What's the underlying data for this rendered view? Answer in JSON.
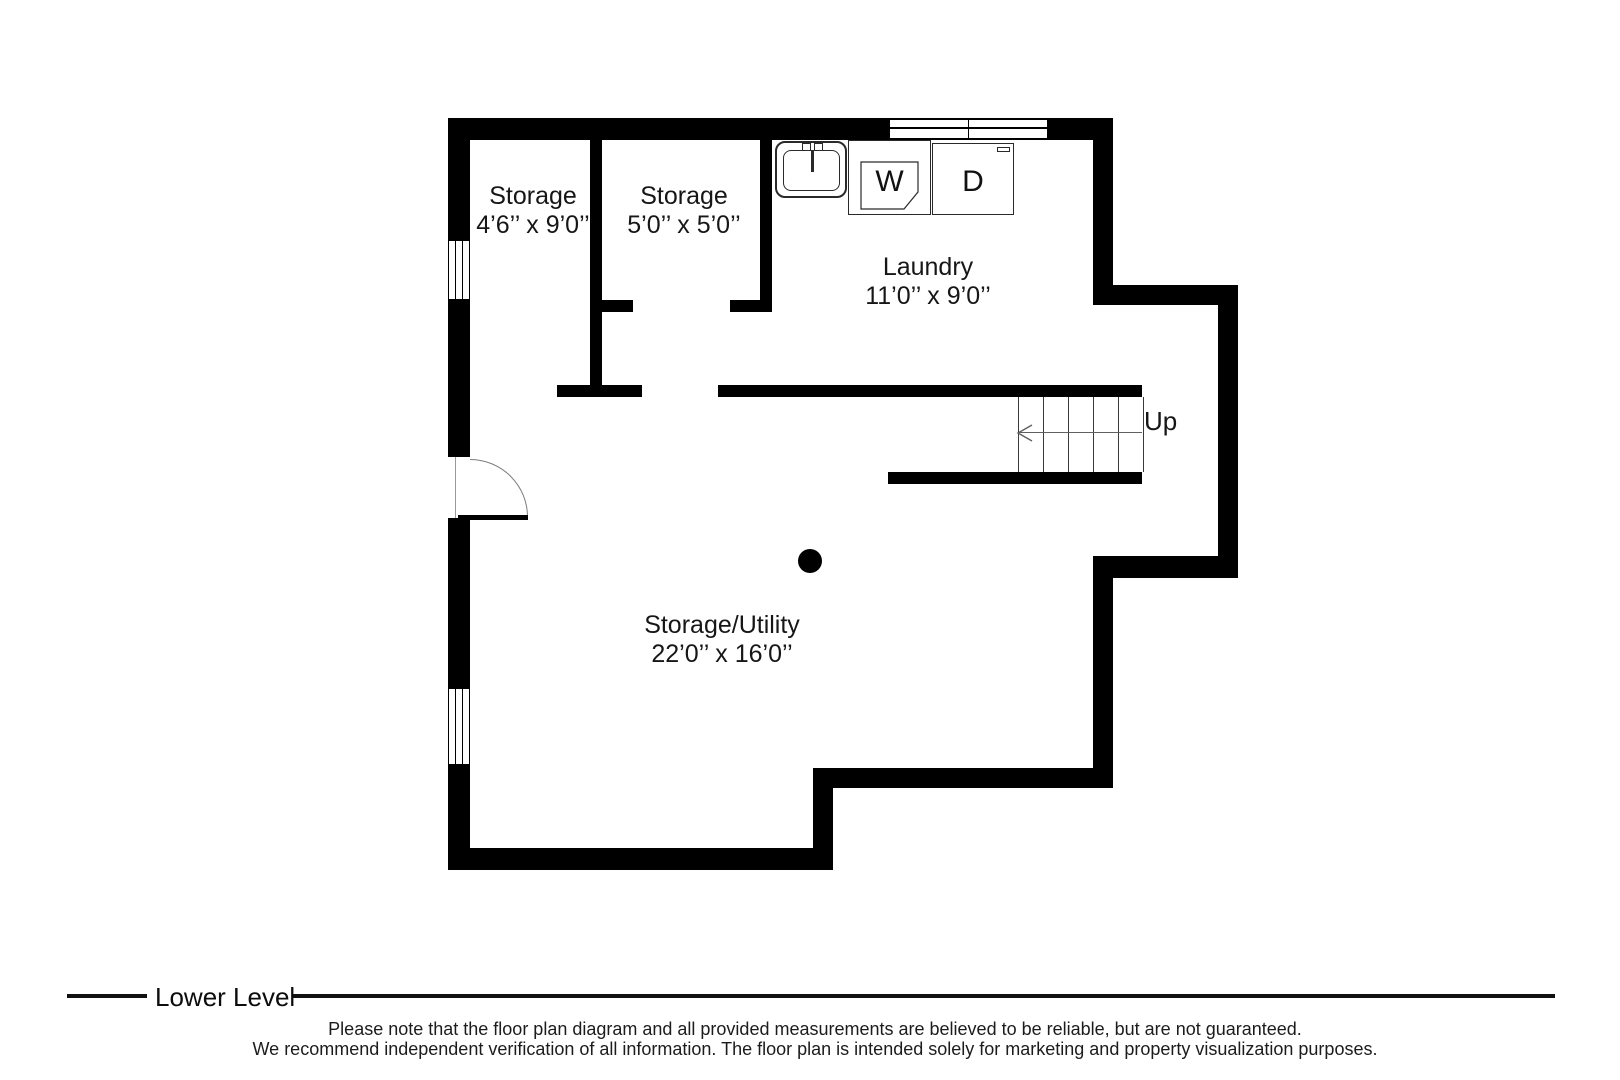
{
  "rooms": [
    {
      "name": "Storage",
      "dims": "4’6’’ x 9’0’’"
    },
    {
      "name": "Storage",
      "dims": "5’0’’ x 5’0’’"
    },
    {
      "name": "Laundry",
      "dims": "11’0’’ x 9’0’’"
    },
    {
      "name": "Storage/Utility",
      "dims": "22’0’’ x 16’0’’"
    }
  ],
  "appliances": {
    "washer": "W",
    "dryer": "D"
  },
  "stairs": {
    "direction_label": "Up"
  },
  "icons": [
    "sink-icon",
    "washer-icon",
    "dryer-icon",
    "door-swing-icon",
    "stairs-up-arrow-icon",
    "column-dot-icon",
    "window-icon"
  ],
  "footer": {
    "level_label": "Lower Level",
    "disclaimer_line1": "Please note that the floor plan diagram and all provided measurements are believed to be reliable, but are not guaranteed.",
    "disclaimer_line2": "We recommend independent verification of all information. The floor plan is intended solely for marketing and property visualization purposes."
  },
  "colors": {
    "wall": "#000000",
    "background": "#ffffff",
    "text": "#161616"
  }
}
